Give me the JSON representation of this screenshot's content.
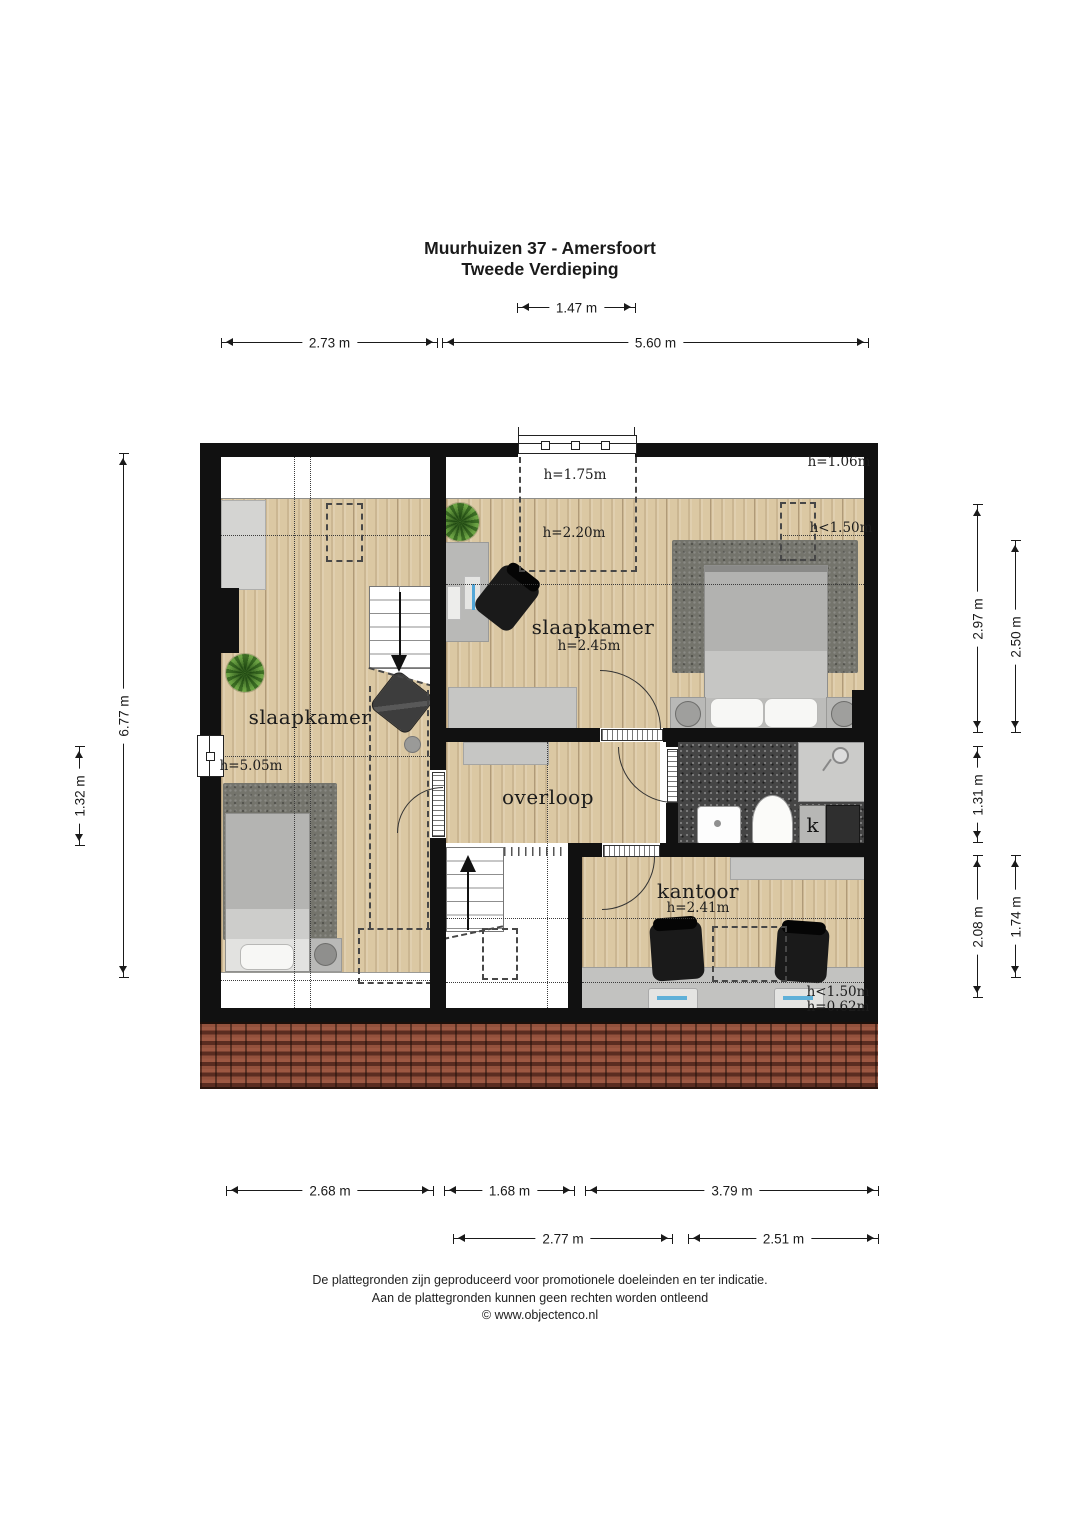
{
  "page": {
    "title_line1": "Muurhuizen 37 - Amersfoort",
    "title_line2": "Tweede Verdieping",
    "footer_line1": "De plattegronden zijn geproduceerd voor promotionele doeleinden en ter indicatie.",
    "footer_line2": "Aan de plattegronden kunnen geen rechten worden ontleend",
    "footer_line3": "© www.objectenco.nl"
  },
  "rooms": {
    "bedroom_left": {
      "label": "slaapkamer",
      "height": "h=5.05m"
    },
    "bedroom_right": {
      "label": "slaapkamer",
      "height": "h=2.45m"
    },
    "landing": {
      "label": "overloop"
    },
    "office": {
      "label": "kantoor",
      "height": "h=2.41m"
    },
    "closet": {
      "label": "k"
    }
  },
  "annotations": {
    "dormer": "h=1.75m",
    "top_right": "h=1.06m",
    "bedroom_right_zone": "h=2.20m",
    "bedroom_right_low": "h<1.50m",
    "office_low": "h<1.50m",
    "office_knee": "h=0.62m"
  },
  "dimensions": {
    "top_dormer": "1.47 m",
    "top_left": "2.73 m",
    "top_right": "5.60 m",
    "left_total": "6.77 m",
    "left_window": "1.32 m",
    "right_bedroom_outer": "2.97 m",
    "right_bedroom_inner": "2.50 m",
    "right_bathroom": "1.31 m",
    "right_office_outer": "2.08 m",
    "right_office_inner": "1.74 m",
    "bottom_bedroom": "2.68 m",
    "bottom_stairwell": "1.68 m",
    "bottom_office": "3.79 m",
    "bottom_landing": "2.77 m",
    "bottom_bathroom": "2.51 m"
  },
  "colors": {
    "wall": "#111111",
    "wood": "#dbc8a3",
    "rug": "#74746c",
    "bathroom_floor": "#454545",
    "roof_tile": "#93513c",
    "furniture": "#c6c6c4",
    "seat_black": "#1a1a1a",
    "plant": "#558630"
  }
}
